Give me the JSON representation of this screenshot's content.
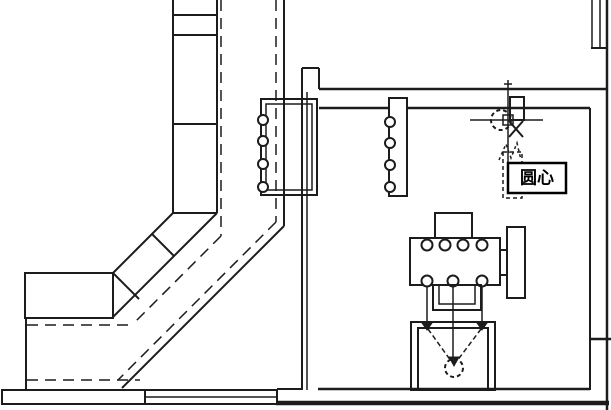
{
  "colors": {
    "background": "#ffffff",
    "line": "#1c1c1c",
    "tooltip_bg": "#ffffff",
    "tooltip_border": "#000000"
  },
  "tooltip": {
    "label": "圆心",
    "x": 508,
    "y": 163,
    "width": 58,
    "height": 30
  },
  "cursor": {
    "x": 508,
    "y": 120,
    "snap_marker": "center-circle"
  },
  "drawing": {
    "width": 611,
    "height": 410,
    "shapes": [
      {
        "type": "line",
        "name": "conveyor-centerline-vertical",
        "x1": 221,
        "y1": 0,
        "x2": 221,
        "y2": 236,
        "w": 1.5,
        "dash": "11,7"
      },
      {
        "type": "line",
        "name": "conveyor-centerline-diagonal",
        "x1": 221,
        "y1": 236,
        "x2": 133,
        "y2": 324,
        "w": 1.5,
        "dash": "11,7"
      },
      {
        "type": "line",
        "name": "conveyor-centerline-horizontal",
        "x1": 27,
        "y1": 325,
        "x2": 133,
        "y2": 325,
        "w": 1.5,
        "dash": "11,7"
      },
      {
        "type": "line",
        "name": "track-dashed-vertical",
        "x1": 276,
        "y1": 0,
        "x2": 276,
        "y2": 222,
        "w": 1.5,
        "dash": "11,7"
      },
      {
        "type": "line",
        "name": "track-dashed-diagonal",
        "x1": 276,
        "y1": 222,
        "x2": 118,
        "y2": 380,
        "w": 1.5,
        "dash": "11,7"
      },
      {
        "type": "line",
        "name": "track-dashed-horizontal",
        "x1": 27,
        "y1": 380,
        "x2": 140,
        "y2": 380,
        "w": 1.5,
        "dash": "11,7"
      },
      {
        "type": "line",
        "name": "track-solid-vertical",
        "x1": 284,
        "y1": 0,
        "x2": 284,
        "y2": 226,
        "w": 2
      },
      {
        "type": "line",
        "name": "track-solid-diagonal",
        "x1": 284,
        "y1": 226,
        "x2": 122,
        "y2": 388,
        "w": 2
      },
      {
        "type": "line",
        "name": "belt-left-edge",
        "x1": 173,
        "y1": 0,
        "x2": 173,
        "y2": 213,
        "w": 2
      },
      {
        "type": "line",
        "name": "belt-right-edge",
        "x1": 217,
        "y1": 0,
        "x2": 217,
        "y2": 213,
        "w": 2
      },
      {
        "type": "line",
        "name": "belt-rung-1",
        "x1": 173,
        "y1": 15,
        "x2": 217,
        "y2": 15,
        "w": 2
      },
      {
        "type": "line",
        "name": "belt-rung-2",
        "x1": 173,
        "y1": 35,
        "x2": 217,
        "y2": 35,
        "w": 2
      },
      {
        "type": "line",
        "name": "belt-rung-3",
        "x1": 173,
        "y1": 124,
        "x2": 217,
        "y2": 124,
        "w": 2
      },
      {
        "type": "line",
        "name": "belt-rung-4",
        "x1": 173,
        "y1": 213,
        "x2": 217,
        "y2": 213,
        "w": 2
      },
      {
        "type": "line",
        "name": "belt-diagonal-upper",
        "x1": 173,
        "y1": 213,
        "x2": 113,
        "y2": 273,
        "w": 2
      },
      {
        "type": "line",
        "name": "belt-diagonal-lower",
        "x1": 217,
        "y1": 213,
        "x2": 112,
        "y2": 318,
        "w": 2
      },
      {
        "type": "line",
        "name": "belt-diagonal-rung-1",
        "x1": 152,
        "y1": 234,
        "x2": 174,
        "y2": 256,
        "w": 2
      },
      {
        "type": "line",
        "name": "belt-diagonal-rung-2",
        "x1": 113,
        "y1": 273,
        "x2": 139,
        "y2": 299,
        "w": 2
      },
      {
        "type": "rect",
        "name": "belt-end-box",
        "x": 25,
        "y": 273,
        "width": 88,
        "height": 45,
        "w": 2
      },
      {
        "type": "line",
        "name": "belt-end-left-extension",
        "x1": 26,
        "y1": 318,
        "x2": 26,
        "y2": 390,
        "w": 2
      },
      {
        "type": "rect",
        "name": "floor-band-left",
        "x": 2,
        "y": 390,
        "width": 143,
        "height": 14,
        "w": 2,
        "fill": "#ffffff"
      },
      {
        "type": "rect",
        "name": "floor-band-mid",
        "x": 145,
        "y": 390,
        "width": 132,
        "height": 14,
        "w": 2,
        "fill": "#ffffff"
      },
      {
        "type": "line",
        "name": "floor-band-mid-line",
        "x1": 145,
        "y1": 397,
        "x2": 277,
        "y2": 397,
        "w": 1.5
      },
      {
        "type": "line",
        "name": "ground-line",
        "x1": 276,
        "y1": 403,
        "x2": 609,
        "y2": 403,
        "w": 4.5
      },
      {
        "type": "line",
        "name": "wall-step-top",
        "x1": 302,
        "y1": 68,
        "x2": 319,
        "y2": 68,
        "w": 2
      },
      {
        "type": "line",
        "name": "left-wall-outer",
        "x1": 302,
        "y1": 68,
        "x2": 302,
        "y2": 390,
        "w": 2
      },
      {
        "type": "line",
        "name": "left-wall-inner",
        "x1": 307,
        "y1": 92,
        "x2": 307,
        "y2": 390,
        "w": 1.5
      },
      {
        "type": "line",
        "name": "wall-step-right",
        "x1": 319,
        "y1": 68,
        "x2": 319,
        "y2": 89,
        "w": 2
      },
      {
        "type": "line",
        "name": "top-wall-upper",
        "x1": 319,
        "y1": 89,
        "x2": 607,
        "y2": 89,
        "w": 2.5
      },
      {
        "type": "line",
        "name": "top-wall-lower",
        "x1": 319,
        "y1": 108,
        "x2": 590,
        "y2": 108,
        "w": 2.5
      },
      {
        "type": "line",
        "name": "right-wall-outer",
        "x1": 607,
        "y1": 0,
        "x2": 607,
        "y2": 410,
        "w": 2.5
      },
      {
        "type": "line",
        "name": "right-wall-inner",
        "x1": 590,
        "y1": 108,
        "x2": 590,
        "y2": 390,
        "w": 2
      },
      {
        "type": "line",
        "name": "window-edge-left",
        "x1": 592,
        "y1": 0,
        "x2": 592,
        "y2": 47,
        "w": 1.5
      },
      {
        "type": "line",
        "name": "window-edge-right",
        "x1": 600,
        "y1": 0,
        "x2": 600,
        "y2": 47,
        "w": 1.5
      },
      {
        "type": "line",
        "name": "window-sill",
        "x1": 591,
        "y1": 48,
        "x2": 608,
        "y2": 48,
        "w": 2
      },
      {
        "type": "line",
        "name": "right-wall-shelf",
        "x1": 590,
        "y1": 339,
        "x2": 611,
        "y2": 339,
        "w": 2.5
      },
      {
        "type": "line",
        "name": "room-floor-line",
        "x1": 318,
        "y1": 389,
        "x2": 590,
        "y2": 389,
        "w": 2.5
      },
      {
        "type": "line",
        "name": "floor-left-segment",
        "x1": 277,
        "y1": 389,
        "x2": 301,
        "y2": 389,
        "w": 2
      },
      {
        "type": "rect",
        "name": "rack-outer",
        "x": 261,
        "y": 99,
        "width": 56,
        "height": 96,
        "w": 2
      },
      {
        "type": "rect",
        "name": "rack-inner",
        "x": 266,
        "y": 104,
        "width": 46,
        "height": 86,
        "w": 1.5
      },
      {
        "type": "circle",
        "name": "rack-roller-1",
        "cx": 263,
        "cy": 120,
        "r": 5,
        "w": 2,
        "fill": "#ffffff"
      },
      {
        "type": "circle",
        "name": "rack-roller-2",
        "cx": 263,
        "cy": 141,
        "r": 5,
        "w": 2,
        "fill": "#ffffff"
      },
      {
        "type": "circle",
        "name": "rack-roller-3",
        "cx": 263,
        "cy": 164,
        "r": 5,
        "w": 2,
        "fill": "#ffffff"
      },
      {
        "type": "circle",
        "name": "rack-roller-4",
        "cx": 263,
        "cy": 187,
        "r": 5,
        "w": 2,
        "fill": "#ffffff"
      },
      {
        "type": "rect",
        "name": "roller-plate",
        "x": 389,
        "y": 98,
        "width": 18,
        "height": 98,
        "w": 2,
        "fill": "#ffffff"
      },
      {
        "type": "circle",
        "name": "plate-roller-1",
        "cx": 390,
        "cy": 122,
        "r": 5,
        "w": 2,
        "fill": "#ffffff"
      },
      {
        "type": "circle",
        "name": "plate-roller-2",
        "cx": 390,
        "cy": 143,
        "r": 5,
        "w": 2,
        "fill": "#ffffff"
      },
      {
        "type": "circle",
        "name": "plate-roller-3",
        "cx": 390,
        "cy": 165,
        "r": 5,
        "w": 2,
        "fill": "#ffffff"
      },
      {
        "type": "circle",
        "name": "plate-roller-4",
        "cx": 390,
        "cy": 187,
        "r": 5,
        "w": 2,
        "fill": "#ffffff"
      },
      {
        "type": "rect",
        "name": "machine-top-block",
        "x": 435,
        "y": 213,
        "width": 37,
        "height": 27,
        "w": 2,
        "fill": "#ffffff"
      },
      {
        "type": "rect",
        "name": "machine-body",
        "x": 410,
        "y": 238,
        "width": 90,
        "height": 47,
        "w": 2,
        "fill": "#ffffff"
      },
      {
        "type": "circle",
        "name": "machine-port-top-1",
        "cx": 427,
        "cy": 245,
        "r": 5.5,
        "w": 2,
        "fill": "#ffffff"
      },
      {
        "type": "circle",
        "name": "machine-port-top-2",
        "cx": 445,
        "cy": 245,
        "r": 5.5,
        "w": 2,
        "fill": "#ffffff"
      },
      {
        "type": "circle",
        "name": "machine-port-top-3",
        "cx": 463,
        "cy": 245,
        "r": 5.5,
        "w": 2,
        "fill": "#ffffff"
      },
      {
        "type": "circle",
        "name": "machine-port-top-4",
        "cx": 482,
        "cy": 245,
        "r": 5.5,
        "w": 2,
        "fill": "#ffffff"
      },
      {
        "type": "circle",
        "name": "machine-port-bottom-1",
        "cx": 427,
        "cy": 281,
        "r": 5.5,
        "w": 2,
        "fill": "#ffffff"
      },
      {
        "type": "circle",
        "name": "machine-port-bottom-2",
        "cx": 453,
        "cy": 281,
        "r": 5.5,
        "w": 2,
        "fill": "#ffffff"
      },
      {
        "type": "circle",
        "name": "machine-port-bottom-3",
        "cx": 482,
        "cy": 281,
        "r": 5.5,
        "w": 2,
        "fill": "#ffffff"
      },
      {
        "type": "line",
        "name": "machine-connector-upper",
        "x1": 500,
        "y1": 250,
        "x2": 507,
        "y2": 250,
        "w": 2
      },
      {
        "type": "line",
        "name": "machine-connector-lower",
        "x1": 500,
        "y1": 275,
        "x2": 507,
        "y2": 275,
        "w": 2
      },
      {
        "type": "rect",
        "name": "machine-flange",
        "x": 507,
        "y": 227,
        "width": 18,
        "height": 71,
        "w": 2,
        "fill": "#ffffff"
      },
      {
        "type": "rect",
        "name": "machine-bracket-outer",
        "x": 433,
        "y": 285,
        "width": 48,
        "height": 25,
        "w": 2
      },
      {
        "type": "rect",
        "name": "machine-bracket-inner",
        "x": 439,
        "y": 285,
        "width": 36,
        "height": 19,
        "w": 1.5
      },
      {
        "type": "line",
        "name": "machine-column-left",
        "x1": 427,
        "y1": 286,
        "x2": 427,
        "y2": 325,
        "w": 1.5
      },
      {
        "type": "line",
        "name": "machine-column-center",
        "x1": 453,
        "y1": 286,
        "x2": 453,
        "y2": 360,
        "w": 1.5
      },
      {
        "type": "line",
        "name": "machine-column-right",
        "x1": 482,
        "y1": 286,
        "x2": 482,
        "y2": 325,
        "w": 1.5
      },
      {
        "type": "rect",
        "name": "tank-outer",
        "x": 411,
        "y": 322,
        "width": 84,
        "height": 68,
        "w": 2
      },
      {
        "type": "rect",
        "name": "tank-inner",
        "x": 418,
        "y": 328,
        "width": 70,
        "height": 62,
        "w": 2
      },
      {
        "type": "polygon",
        "name": "tank-entry-mark-left",
        "points": "427,330 422,323 432,323",
        "fill": "#1c1c1c",
        "w": 1
      },
      {
        "type": "polygon",
        "name": "tank-entry-mark-right",
        "points": "482,330 477,323 487,323",
        "fill": "#1c1c1c",
        "w": 1
      },
      {
        "type": "line",
        "name": "tank-funnel-left",
        "x1": 428,
        "y1": 329,
        "x2": 451,
        "y2": 361,
        "w": 1.5,
        "dash": "5,3"
      },
      {
        "type": "line",
        "name": "tank-funnel-right",
        "x1": 481,
        "y1": 329,
        "x2": 457,
        "y2": 361,
        "w": 1.5,
        "dash": "5,3"
      },
      {
        "type": "polygon",
        "name": "tank-arrowhead",
        "points": "454,366 449,357 459,357",
        "fill": "#1c1c1c",
        "w": 1
      },
      {
        "type": "circle",
        "name": "tank-circle",
        "cx": 454,
        "cy": 368,
        "r": 9,
        "w": 2,
        "dash": "4,3"
      },
      {
        "type": "rect",
        "name": "symbol-lower-box",
        "x": 503,
        "y": 152,
        "width": 19,
        "height": 46,
        "w": 1.5,
        "dash": "4,3"
      },
      {
        "type": "polyline",
        "name": "symbol-zigzag",
        "points": "499,160 506,144 511,158 517,143 521,160",
        "w": 1.5,
        "dash": "3,3"
      },
      {
        "type": "rect",
        "name": "symbol-rect",
        "x": 510,
        "y": 97,
        "width": 14,
        "height": 23,
        "w": 2
      },
      {
        "type": "line",
        "name": "symbol-diag-1",
        "x1": 509,
        "y1": 121,
        "x2": 523,
        "y2": 137,
        "w": 2
      },
      {
        "type": "line",
        "name": "symbol-diag-2",
        "x1": 523,
        "y1": 121,
        "x2": 509,
        "y2": 137,
        "w": 2
      },
      {
        "type": "circle",
        "name": "center-snap-marker",
        "cx": 501,
        "cy": 120,
        "r": 10,
        "w": 2,
        "dash": "4,3"
      },
      {
        "type": "line",
        "name": "crosshair-horizontal",
        "x1": 470,
        "y1": 120,
        "x2": 543,
        "y2": 120,
        "w": 1.5
      },
      {
        "type": "line",
        "name": "crosshair-vertical",
        "x1": 508,
        "y1": 80,
        "x2": 508,
        "y2": 163,
        "w": 1.5
      },
      {
        "type": "line",
        "name": "crosshair-top-tick",
        "x1": 504,
        "y1": 84,
        "x2": 512,
        "y2": 84,
        "w": 1.5
      },
      {
        "type": "rect",
        "name": "pickbox",
        "x": 503,
        "y": 115,
        "width": 10,
        "height": 10,
        "w": 1.5
      }
    ]
  }
}
